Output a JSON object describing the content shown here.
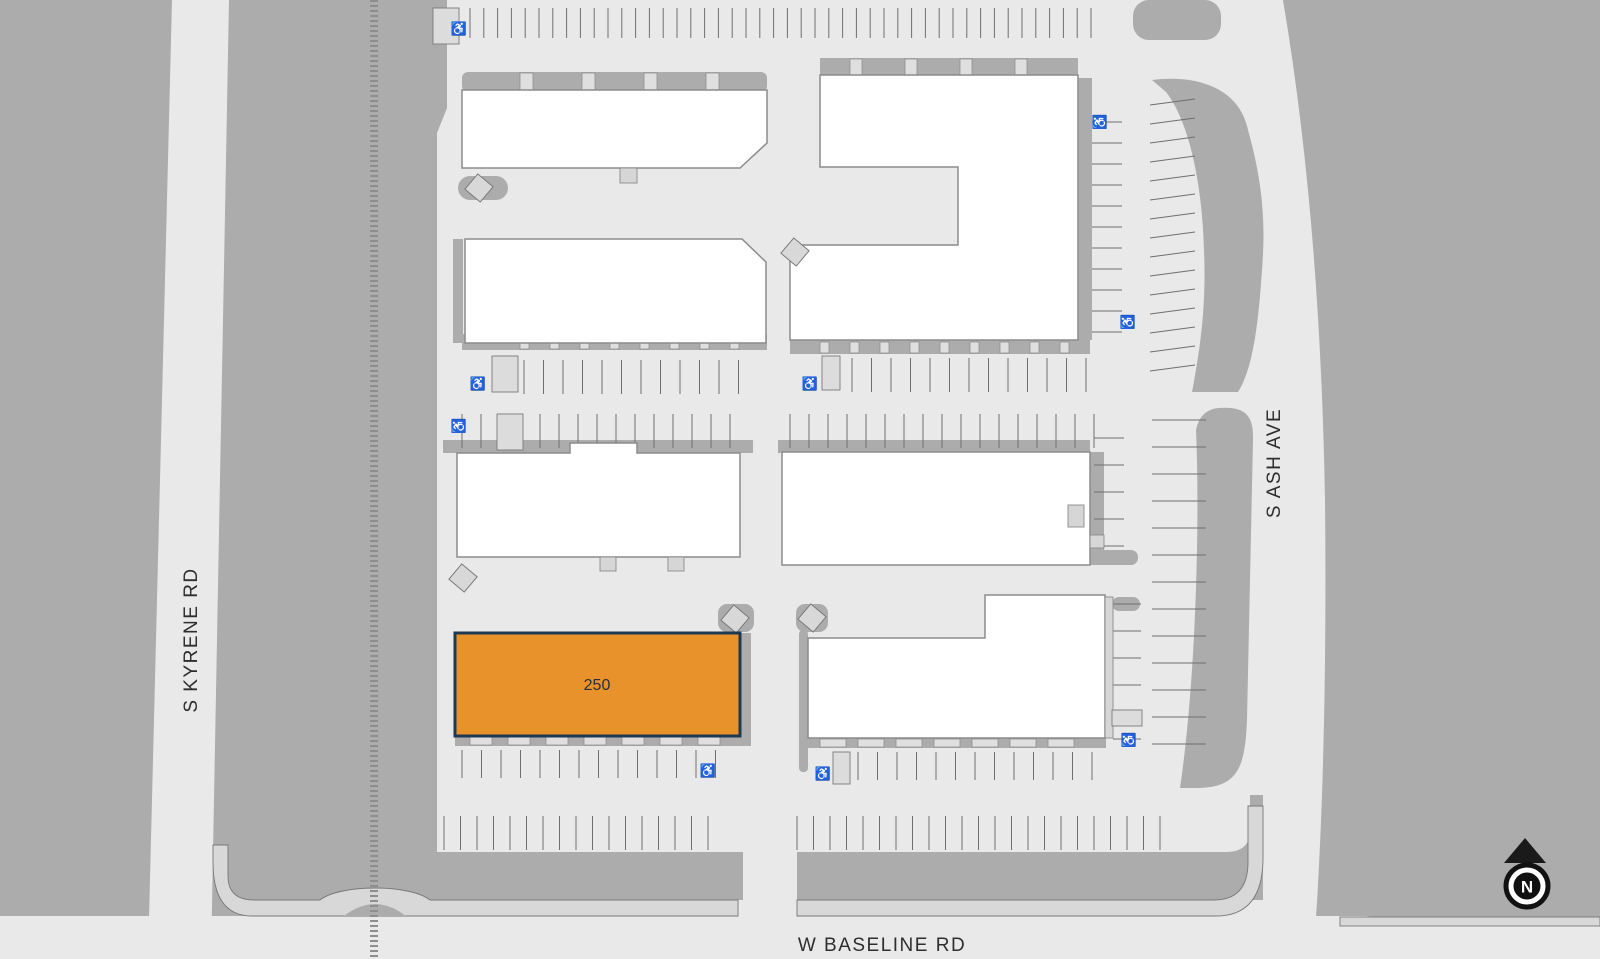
{
  "plan": {
    "streets": {
      "west": {
        "label": "S KYRENE RD"
      },
      "east": {
        "label": "S ASH AVE"
      },
      "south": {
        "label": "W BASELINE RD"
      }
    },
    "suite": {
      "label": "250",
      "fill": "#E8922C",
      "border": "#1E3A52"
    },
    "compass": {
      "label": "N"
    },
    "icons": {
      "accessible_parking": "♿"
    },
    "colors": {
      "parcel_gray": "#ACACAC",
      "paving": "#E9E9E9",
      "sidewalk": "#D8D8D8",
      "building_white": "#FFFFFF",
      "parking_line": "#6F6F6F"
    }
  }
}
